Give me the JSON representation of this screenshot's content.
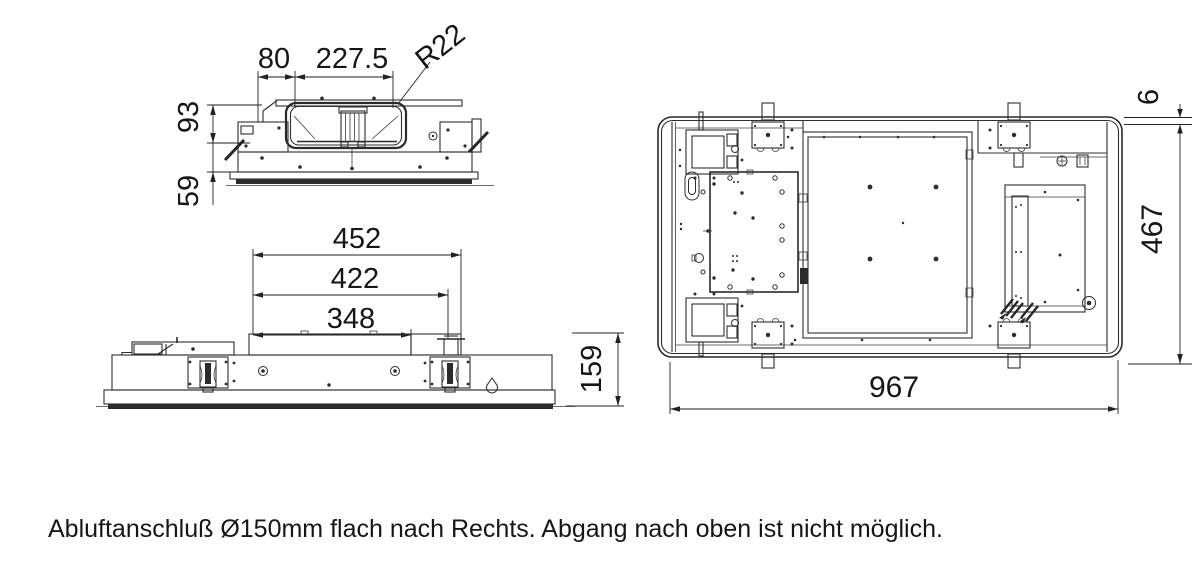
{
  "dims": {
    "side": {
      "seg_left": "80",
      "seg_duct": "227.5",
      "radius": "R22",
      "h_upper": "93",
      "h_lower": "59"
    },
    "front": {
      "w_outer": "452",
      "w_mid": "422",
      "w_inner": "348",
      "h": "159"
    },
    "top": {
      "gap": "6",
      "depth": "467",
      "width": "967"
    }
  },
  "caption": {
    "text": "Abluftanschluß Ø150mm flach nach Rechts. Abgang nach oben ist nicht möglich."
  },
  "colors": {
    "line": "#2f2f2f",
    "dimension": "#222222",
    "text": "#161616",
    "background": "#ffffff"
  }
}
